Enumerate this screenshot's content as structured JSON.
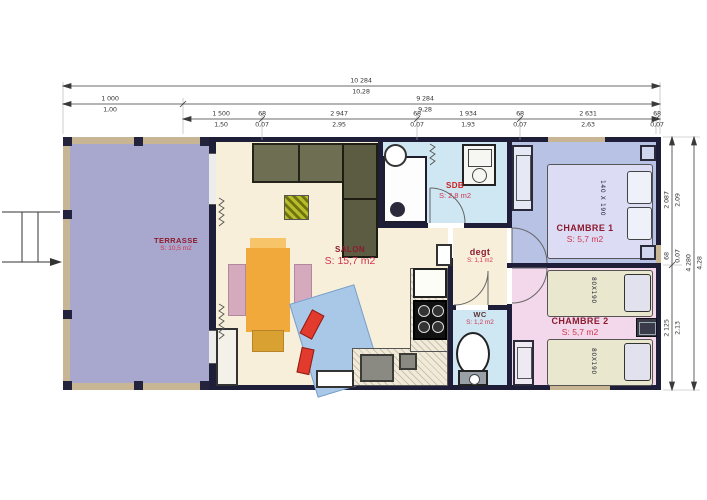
{
  "plan": {
    "rooms": {
      "terrasse": {
        "name": "TERRASSE",
        "area": "S: 10,5 m2"
      },
      "salon": {
        "name": "SALON",
        "area": "S: 15,7 m2"
      },
      "sdb": {
        "name": "SDB",
        "area": "S: 2,8 m2"
      },
      "degt": {
        "name": "degt",
        "area": "S: 1,1 m2"
      },
      "wc": {
        "name": "WC",
        "area": "S: 1,2 m2"
      },
      "chambre1": {
        "name": "CHAMBRE 1",
        "area": "S: 5,7 m2",
        "bed": "140 X 190"
      },
      "chambre2": {
        "name": "CHAMBRE 2",
        "area": "S: 5,7 m2",
        "bed1": "80X190",
        "bed2": "80X190"
      }
    },
    "dimensions": {
      "top_row1": {
        "mm": "10 284",
        "m": "10,28"
      },
      "top_row2": [
        {
          "mm": "1 000",
          "m": "1,00"
        },
        {
          "mm": "9 284",
          "m": "9,28"
        }
      ],
      "top_row3": [
        {
          "mm": "1 500",
          "m": "1,50"
        },
        {
          "mm": "68",
          "m": "0,07"
        },
        {
          "mm": "2 947",
          "m": "2,95"
        },
        {
          "mm": "68",
          "m": "0,07"
        },
        {
          "mm": "1 934",
          "m": "1,93"
        },
        {
          "mm": "68",
          "m": "0,07"
        },
        {
          "mm": "2 631",
          "m": "2,63"
        },
        {
          "mm": "68",
          "m": "0,07"
        }
      ],
      "right_overall": {
        "mm": "4 280",
        "m": "4,28"
      },
      "right_segments": [
        {
          "mm": "2 087",
          "m": "2,09"
        },
        {
          "mm": "68",
          "m": "0,07"
        },
        {
          "mm": "2 125",
          "m": "2,13"
        }
      ]
    },
    "colors": {
      "wall": "#1e1e38",
      "terrasse_floor": "#a8a7cd",
      "terrasse_frame": "#c8b593",
      "salon_floor": "#f8efda",
      "sdb_floor": "#cfe7f2",
      "wc_floor": "#cfe7f2",
      "chambre1_floor": "#b7c2e4",
      "chambre2_floor": "#f3d7eb",
      "room_name_text": "#8c1b2f",
      "room_area_text": "#d2344e",
      "cabinet_olive": "#6e6e52",
      "table_orange": "#f2a93c",
      "sofa_blue": "#a9c8e8",
      "cushion_red": "#e23b2e"
    }
  }
}
